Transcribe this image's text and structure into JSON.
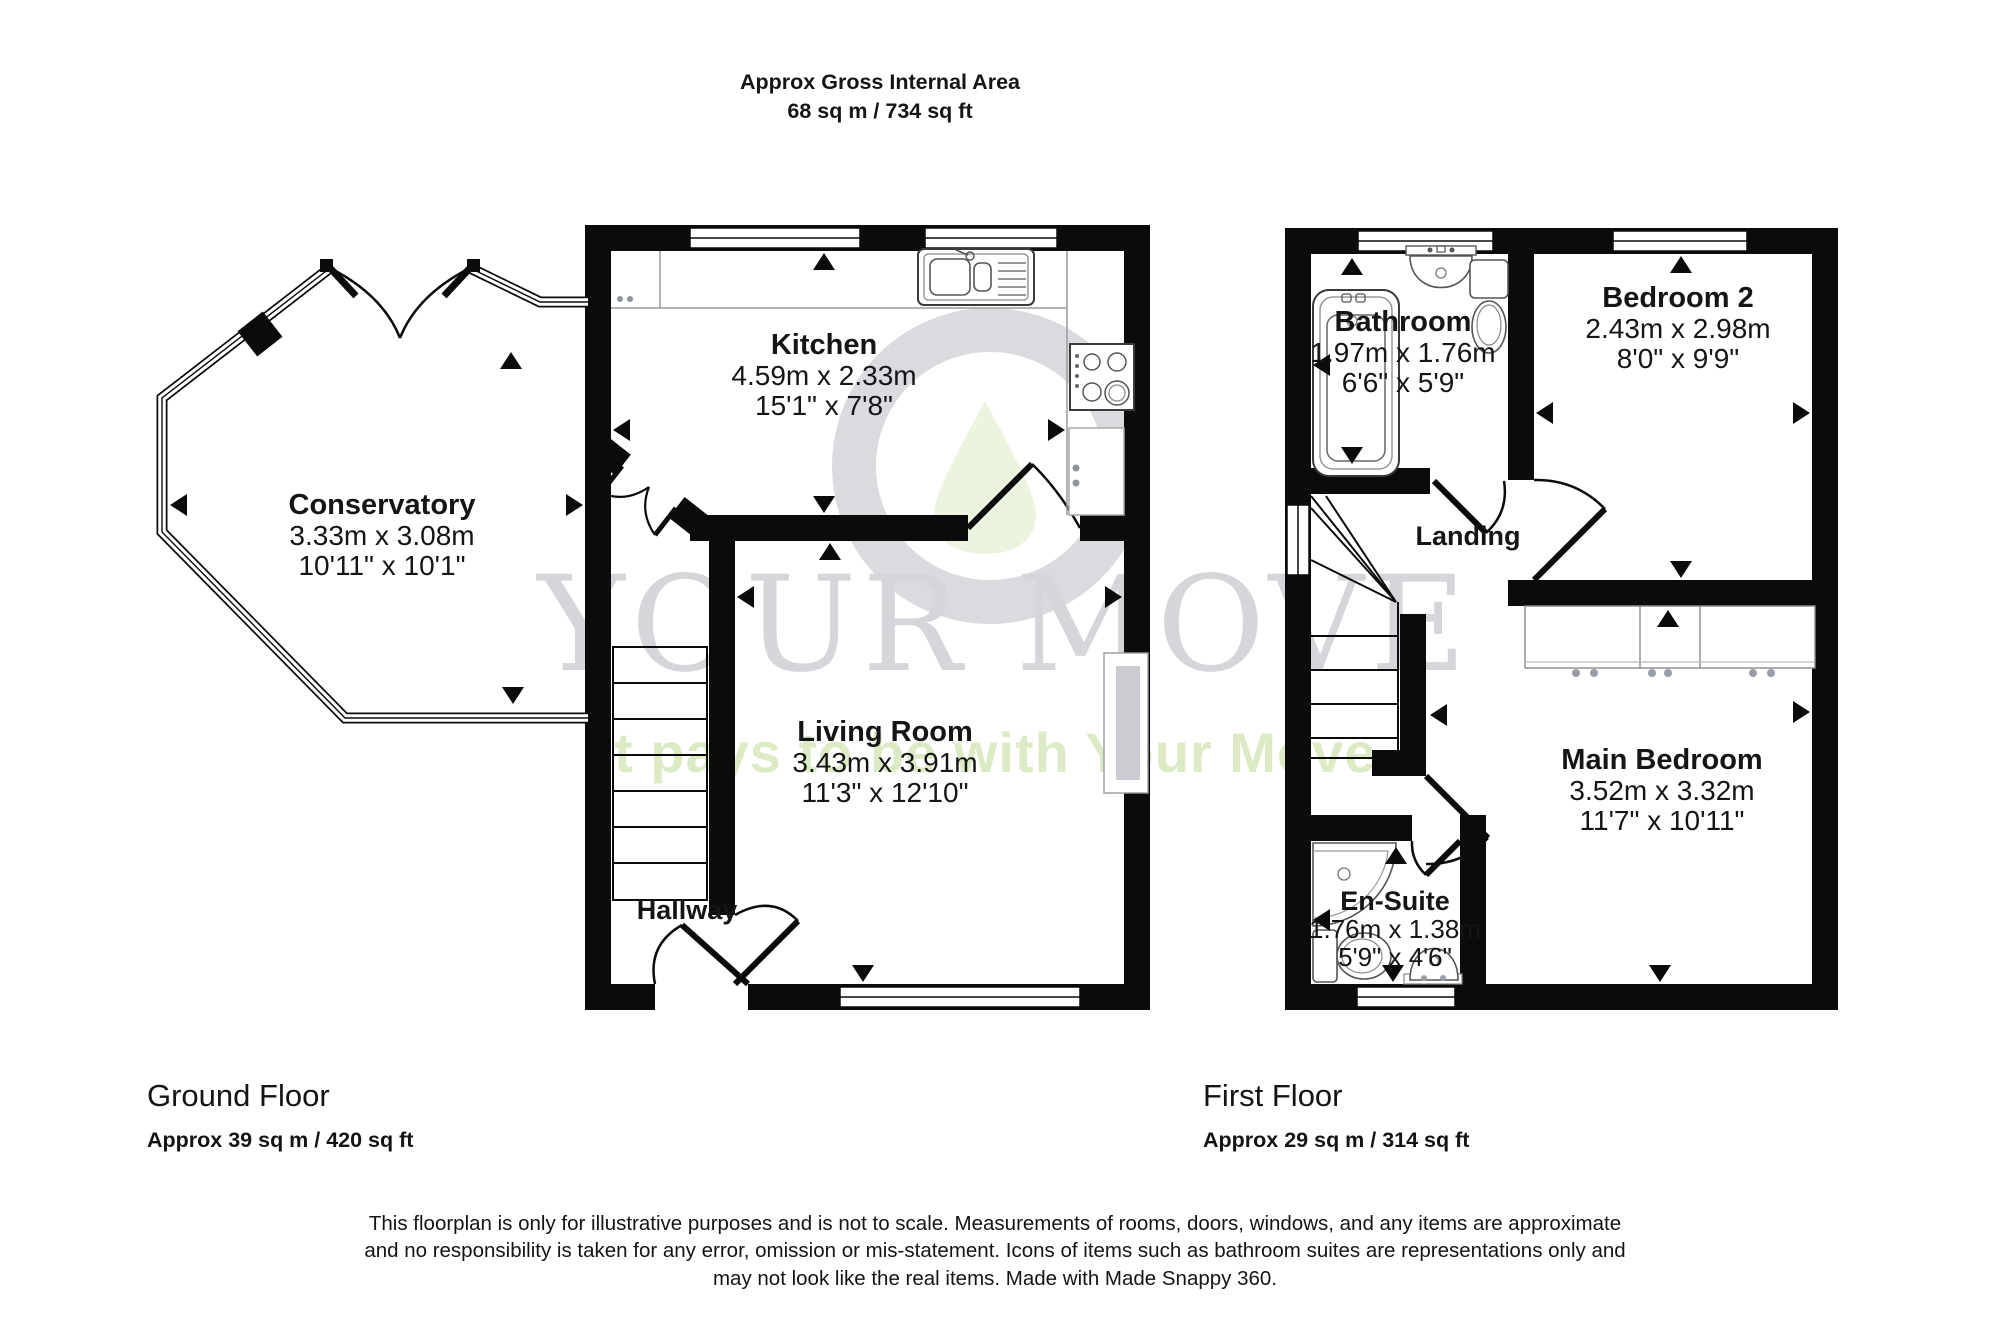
{
  "header": {
    "title": "Approx Gross Internal Area",
    "area": "68 sq m / 734 sq ft"
  },
  "watermark": {
    "brand": "YOUR MOVE",
    "tagline": "It pays to be with Your Move",
    "ring_color": "#d9dbdf",
    "leaf_color": "#ecf3de",
    "brand_color": "#d4d6da",
    "tagline_color": "#dcebc5"
  },
  "colors": {
    "walls": "#0b0b0b",
    "fixtures": "#555555"
  },
  "ground_floor": {
    "name": "Ground Floor",
    "area": "Approx 39 sq m / 420 sq ft",
    "rooms": {
      "conservatory": {
        "name": "Conservatory",
        "metric": "3.33m x 3.08m",
        "imperial": "10'11\" x 10'1\""
      },
      "kitchen": {
        "name": "Kitchen",
        "metric": "4.59m x 2.33m",
        "imperial": "15'1\" x 7'8\""
      },
      "living_room": {
        "name": "Living Room",
        "metric": "3.43m x 3.91m",
        "imperial": "11'3\" x 12'10\""
      },
      "hallway": {
        "name": "Hallway"
      }
    }
  },
  "first_floor": {
    "name": "First Floor",
    "area": "Approx 29 sq m / 314 sq ft",
    "rooms": {
      "bathroom": {
        "name": "Bathroom",
        "metric": "1.97m x 1.76m",
        "imperial": "6'6\" x 5'9\""
      },
      "bedroom2": {
        "name": "Bedroom 2",
        "metric": "2.43m x 2.98m",
        "imperial": "8'0\" x 9'9\""
      },
      "landing": {
        "name": "Landing"
      },
      "main_bedroom": {
        "name": "Main Bedroom",
        "metric": "3.52m x 3.32m",
        "imperial": "11'7\" x 10'11\""
      },
      "ensuite": {
        "name": "En-Suite",
        "metric": "1.76m x 1.38m",
        "imperial": "5'9\" x 4'6\""
      }
    }
  },
  "disclaimer": {
    "line1": "This floorplan is only for illustrative purposes and is not to scale. Measurements of rooms, doors, windows, and any items are approximate",
    "line2": "and no responsibility is taken for any error, omission or mis-statement. Icons of items such as bathroom suites are representations only and",
    "line3": "may not look like the real items. Made with Made Snappy 360."
  }
}
